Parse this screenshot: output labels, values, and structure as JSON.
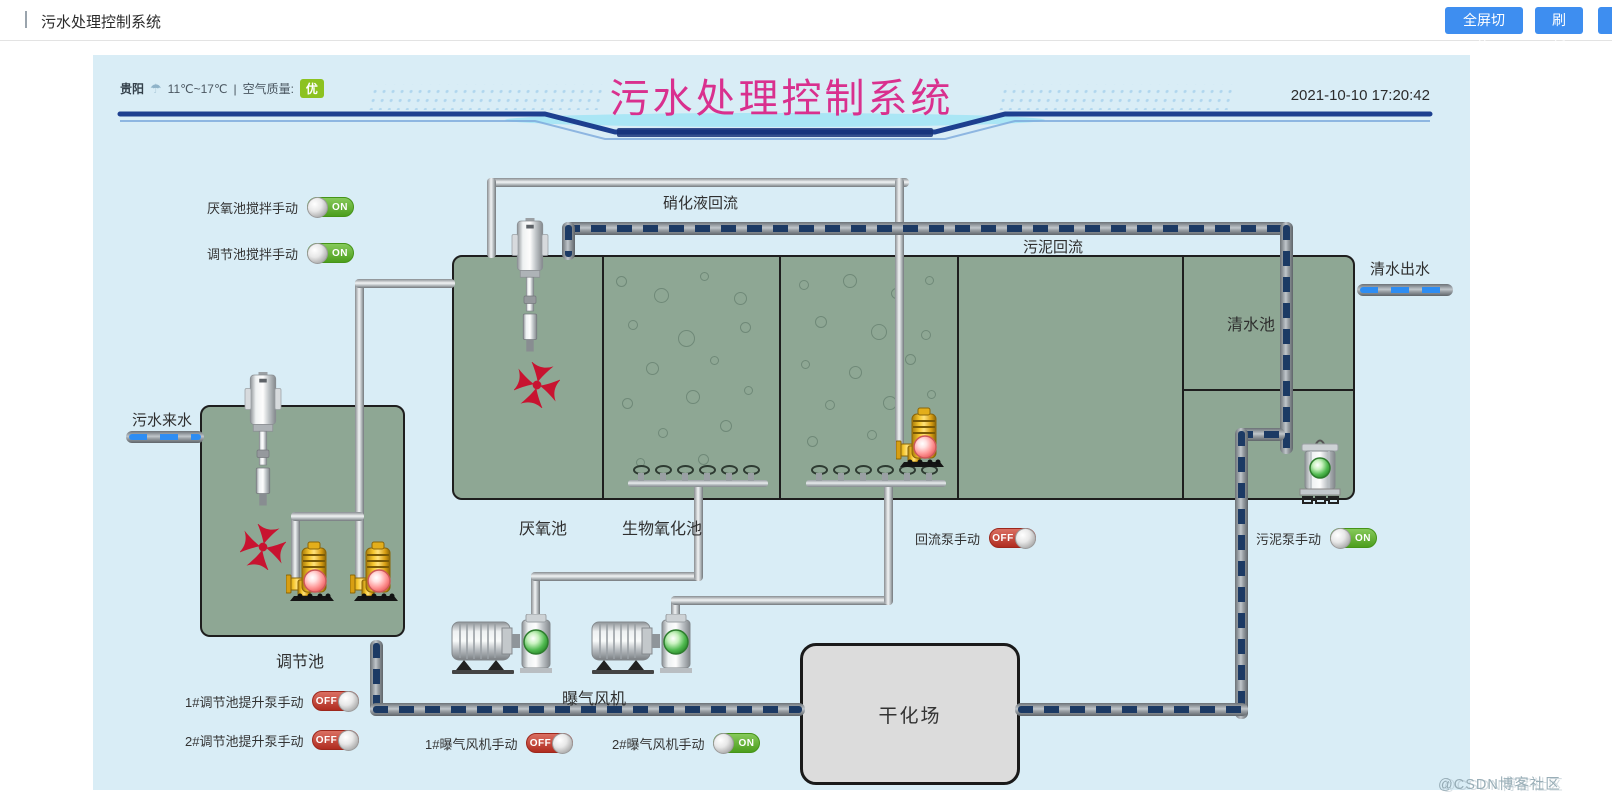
{
  "topbar": {
    "title": "污水处理控制系统",
    "fullscreen_button": "全屏切换",
    "refresh_button": "刷新"
  },
  "header": {
    "city": "贵阳",
    "temperature": "11℃~17℃",
    "separator": "|",
    "air_quality_label": "空气质量:",
    "air_quality_value": "优",
    "title": "污水处理控制系统",
    "datetime": "2021-10-10 17:20:42"
  },
  "diagram": {
    "pipe_labels": {
      "nitrification_return": "硝化液回流",
      "sludge_return": "污泥回流",
      "clean_water_out": "清水出水",
      "sewage_in": "污水来水"
    },
    "tank_labels": {
      "anaerobic": "厌氧池",
      "bio_oxidation": "生物氧化池",
      "clean_water": "清水池",
      "regulation": "调节池",
      "blower": "曝气风机",
      "drying_yard": "干化场"
    }
  },
  "toggles": [
    {
      "id": "anaerobic-mixer",
      "label": "厌氧池搅拌手动",
      "state": "ON"
    },
    {
      "id": "regulation-mixer",
      "label": "调节池搅拌手动",
      "state": "ON"
    },
    {
      "id": "return-pump",
      "label": "回流泵手动",
      "state": "OFF"
    },
    {
      "id": "sludge-pump",
      "label": "污泥泵手动",
      "state": "ON"
    },
    {
      "id": "lift-pump-1",
      "label": "1#调节池提升泵手动",
      "state": "OFF"
    },
    {
      "id": "lift-pump-2",
      "label": "2#调节池提升泵手动",
      "state": "OFF"
    },
    {
      "id": "blower-1",
      "label": "1#曝气风机手动",
      "state": "OFF"
    },
    {
      "id": "blower-2",
      "label": "2#曝气风机手动",
      "state": "ON"
    }
  ],
  "watermark": "@CSDN博客社区",
  "colors": {
    "accent_blue": "#3e8ef0",
    "title_pink": "#d9308e",
    "panel_bg": "#d9edf6",
    "tank_green": "#8ea794",
    "toggle_on": "#4c9e1d",
    "toggle_off": "#b02c20",
    "flow_dash": "#1c3a64",
    "water_dash": "#2e8df2",
    "badge_green": "#8cc220"
  }
}
